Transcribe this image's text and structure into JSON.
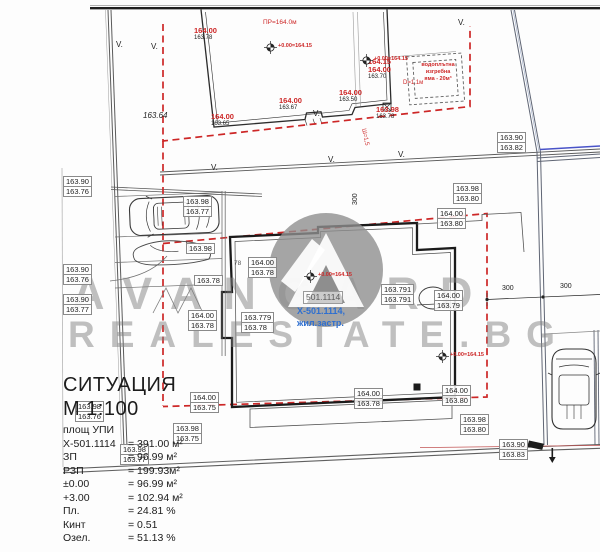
{
  "colors": {
    "red": "#cd2727",
    "blue": "#2e6fd0",
    "pipe_blue": "#4953c8",
    "watermark": "#828282",
    "line_dark": "#2b2b2b"
  },
  "watermark": {
    "line1": "AVANGARD",
    "line2": "REALESTATE.BG"
  },
  "parcel": {
    "box_label": "501.1114",
    "line1": "X-501.1114,",
    "line2": "жил.застр."
  },
  "notes": {
    "pit": "водоплътна\nизгребна\nяма - 20м³",
    "benchmark": "+0.00=164.15"
  },
  "legend": {
    "title": "СИТУАЦИЯ",
    "scale": "М 1:100",
    "rows": [
      {
        "label": "площ УПИ",
        "value": ""
      },
      {
        "label": "X-501.1114",
        "value": "= 391.00 м²"
      },
      {
        "label": "ЗП",
        "value": "= 96.99 м²"
      },
      {
        "label": "РЗП",
        "value": "= 199.93м²"
      },
      {
        "label": "±0.00",
        "value": "= 96.99 м²"
      },
      {
        "label": "+3.00",
        "value": "= 102.94 м²"
      },
      {
        "label": "Пл.",
        "value": "= 24.81 %"
      },
      {
        "label": "Кинт",
        "value": "= 0.51"
      },
      {
        "label": "Озел.",
        "value": "= 51.13 %"
      }
    ]
  },
  "plan": {
    "pairs": [
      {
        "x": 63,
        "y": 176,
        "a": "163.90",
        "b": "163.76"
      },
      {
        "x": 183,
        "y": 196,
        "a": "163.98",
        "b": "163.77"
      },
      {
        "x": 63,
        "y": 264,
        "a": "163.90",
        "b": "163.76"
      },
      {
        "x": 63,
        "y": 294,
        "a": "163.90",
        "b": "163.77"
      },
      {
        "x": 75,
        "y": 401,
        "a": "163.98",
        "b": "163.76"
      },
      {
        "x": 120,
        "y": 444,
        "a": "163.98",
        "b": "163.77"
      },
      {
        "x": 497,
        "y": 132,
        "a": "163.90",
        "b": "163.82"
      },
      {
        "x": 453,
        "y": 183,
        "a": "163.98",
        "b": "163.80"
      },
      {
        "x": 437,
        "y": 208,
        "a": "164.00",
        "b": "163.80"
      },
      {
        "x": 248,
        "y": 257,
        "a": "164.00",
        "b": "163.78"
      },
      {
        "x": 188,
        "y": 310,
        "a": "164.00",
        "b": "163.78"
      },
      {
        "x": 241,
        "y": 312,
        "a": "163.779",
        "b": "163.78"
      },
      {
        "x": 381,
        "y": 284,
        "a": "163.791",
        "b": "163.791"
      },
      {
        "x": 434,
        "y": 290,
        "a": "164.00",
        "b": "163.79"
      },
      {
        "x": 190,
        "y": 392,
        "a": "164.00",
        "b": "163.75"
      },
      {
        "x": 173,
        "y": 423,
        "a": "163.98",
        "b": "163.75"
      },
      {
        "x": 354,
        "y": 388,
        "a": "164.00",
        "b": "163.78"
      },
      {
        "x": 442,
        "y": 385,
        "a": "164.00",
        "b": "163.80"
      },
      {
        "x": 460,
        "y": 414,
        "a": "163.98",
        "b": "163.80"
      },
      {
        "x": 499,
        "y": 439,
        "a": "163.90",
        "b": "163.83"
      }
    ],
    "singles": [
      {
        "x": 186,
        "y": 243,
        "t": "163.98"
      },
      {
        "x": 194,
        "y": 275,
        "t": "163.78"
      },
      {
        "x": 303,
        "y": 291,
        "t": "501.1114",
        "p": 1
      }
    ],
    "red_marks": [
      {
        "x": 194,
        "y": 27,
        "red": "164.00",
        "blk": "163.78"
      },
      {
        "x": 211,
        "y": 113,
        "red": "164.00",
        "blk": "163.65"
      },
      {
        "x": 279,
        "y": 97,
        "red": "164.00",
        "blk": "163.67"
      },
      {
        "x": 339,
        "y": 89,
        "red": "164.00",
        "blk": "163.50"
      },
      {
        "x": 368,
        "y": 58,
        "red": "164.15",
        "red2": "164.00",
        "blk": "163.70"
      },
      {
        "x": 376,
        "y": 106,
        "red": "163.98",
        "blk": "163.78"
      }
    ],
    "benchmarks": [
      {
        "x": 270,
        "y": 47
      },
      {
        "x": 366,
        "y": 60
      },
      {
        "x": 310,
        "y": 276
      },
      {
        "x": 442,
        "y": 356
      }
    ],
    "texts": [
      {
        "x": 263,
        "y": 19,
        "t": "ПР=164.0м",
        "c": "#cd2727",
        "s": 6.5
      },
      {
        "x": 143,
        "y": 111,
        "t": "163.64",
        "s": 8,
        "i": 1
      },
      {
        "x": 234,
        "y": 260,
        "t": "78",
        "c": "#555555",
        "s": 6.5
      },
      {
        "x": 502,
        "y": 285,
        "t": "300",
        "s": 7
      },
      {
        "x": 560,
        "y": 283,
        "t": "300",
        "s": 7
      },
      {
        "x": 352,
        "y": 205,
        "t": "300",
        "s": 7,
        "r": -90
      },
      {
        "x": 366,
        "y": 128,
        "t": "Ш=1,5",
        "c": "#cd2727",
        "s": 6,
        "r": 78
      },
      {
        "x": 403,
        "y": 80,
        "t": "D=1.1м",
        "c": "#cd2727",
        "s": 6
      },
      {
        "x": 116,
        "y": 40,
        "t": "V.",
        "s": 8
      },
      {
        "x": 151,
        "y": 42,
        "t": "V.",
        "s": 8
      },
      {
        "x": 211,
        "y": 163,
        "t": "V.",
        "s": 8
      },
      {
        "x": 313,
        "y": 109,
        "t": "V.",
        "s": 8
      },
      {
        "x": 398,
        "y": 150,
        "t": "V.",
        "s": 8
      },
      {
        "x": 458,
        "y": 18,
        "t": "V.",
        "s": 8
      },
      {
        "x": 328,
        "y": 155,
        "t": "V.",
        "s": 8
      }
    ]
  }
}
